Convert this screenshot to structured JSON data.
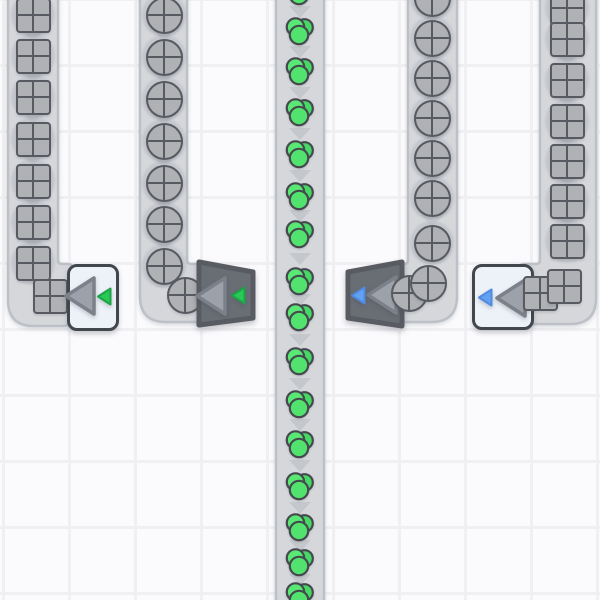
{
  "scene": {
    "name": "conveyor-factory-viewport",
    "width": 600,
    "height": 600,
    "grid": {
      "cell_size": 66,
      "line_width": 3,
      "offset_x": 2,
      "offset_y": 64
    }
  },
  "palette": {
    "background": "#fbfbfd",
    "grid_line": "#f0f0f3",
    "belt_fill": "#d5d7db",
    "belt_edge": "#bdc1c7",
    "belt_chevron": "#c4c8cd",
    "item_gray": "#afb1b4",
    "item_outline": "#575b61",
    "green_light": "#5ae875",
    "green_mid": "#52e26e",
    "green_dark": "#47d965",
    "green_outline": "#45494f",
    "machine_light_fill": "#edf1f8",
    "machine_light_border": "#42474d",
    "machine_dark_fill": "#696e75",
    "machine_dark_border": "#585c62",
    "arrow_fill": "#9da2aa",
    "arrow_outline": "#7b818a",
    "accent_green": "#28c957",
    "accent_green_outline": "#1da446",
    "accent_blue": "#63a2f3",
    "accent_blue_outline": "#4f8be0"
  },
  "belts": [
    {
      "id": "belt-square-left",
      "item": "square",
      "direction": "down",
      "center_x": 33,
      "item_ys": [
        15,
        56,
        97,
        139,
        181,
        222,
        263
      ],
      "path_spec": {
        "x1": 8,
        "x2": 58,
        "turn": "right",
        "stub_x": 74,
        "bottom": 326
      },
      "under_items": [
        [
          50,
          296
        ]
      ],
      "top_items": [],
      "late_items": []
    },
    {
      "id": "belt-circle-left",
      "item": "circle",
      "direction": "down",
      "center_x": 164,
      "item_ys": [
        15,
        57,
        99,
        141,
        183,
        224,
        266
      ],
      "path_spec": {
        "x1": 140,
        "x2": 187,
        "turn": "right",
        "stub_x": 208,
        "bottom": 322
      },
      "under_items": [
        [
          185,
          295
        ]
      ],
      "top_items": [],
      "late_items": []
    },
    {
      "id": "belt-main-green",
      "item": "green",
      "direction": "down",
      "center_x": 300,
      "item_ys": [
        -8,
        32,
        72,
        113,
        155,
        197,
        235,
        282,
        318,
        362,
        405,
        445,
        487,
        528,
        563,
        597
      ],
      "path_spec": {
        "x1": 276,
        "x2": 324,
        "turn": "none"
      },
      "under_items": [],
      "top_items": [],
      "late_items": []
    },
    {
      "id": "belt-circle-right",
      "item": "circle",
      "direction": "down",
      "center_x": 432,
      "item_ys": [
        -2,
        38,
        78,
        118,
        158,
        198,
        243
      ],
      "path_spec": {
        "x1": 408,
        "x2": 457,
        "turn": "left",
        "stub_x": 392,
        "bottom": 322
      },
      "under_items": [],
      "top_items": [
        [
          409,
          293
        ]
      ],
      "late_items": [
        [
          428,
          283
        ]
      ]
    },
    {
      "id": "belt-square-right",
      "item": "square",
      "direction": "down",
      "center_x": 567,
      "item_ys": [
        8,
        39,
        80,
        121,
        161,
        201,
        241
      ],
      "path_spec": {
        "x1": 540,
        "x2": 596,
        "turn": "left",
        "stub_x": 518,
        "bottom": 324
      },
      "under_items": [],
      "top_items": [
        [
          540,
          293
        ]
      ],
      "late_items": [
        [
          564,
          286
        ]
      ]
    }
  ],
  "machines": [
    {
      "id": "arm-white-green-filter",
      "body": "light",
      "accent": "green",
      "rect": [
        67,
        264,
        52,
        67
      ],
      "arrow_pos": [
        63,
        274
      ],
      "chip_pos": [
        96,
        286
      ]
    },
    {
      "id": "arm-dark-green-filter",
      "body": "dark",
      "accent": "green",
      "quad": [
        [
          199,
          262
        ],
        [
          253,
          272
        ],
        [
          253,
          318
        ],
        [
          199,
          325
        ]
      ],
      "arrow_pos": [
        194,
        274
      ],
      "chip_pos": [
        230,
        285
      ]
    },
    {
      "id": "arm-dark-blue-filter",
      "body": "dark",
      "accent": "blue",
      "quad": [
        [
          402,
          262
        ],
        [
          348,
          272
        ],
        [
          348,
          318
        ],
        [
          402,
          326
        ]
      ],
      "arrow_pos": [
        365,
        273
      ],
      "chip_pos": [
        350,
        285
      ]
    },
    {
      "id": "arm-white-blue-filter",
      "body": "light",
      "accent": "blue",
      "rect": [
        472,
        264,
        62,
        66
      ],
      "arrow_pos": [
        494,
        276
      ],
      "chip_pos": [
        477,
        287
      ]
    }
  ]
}
